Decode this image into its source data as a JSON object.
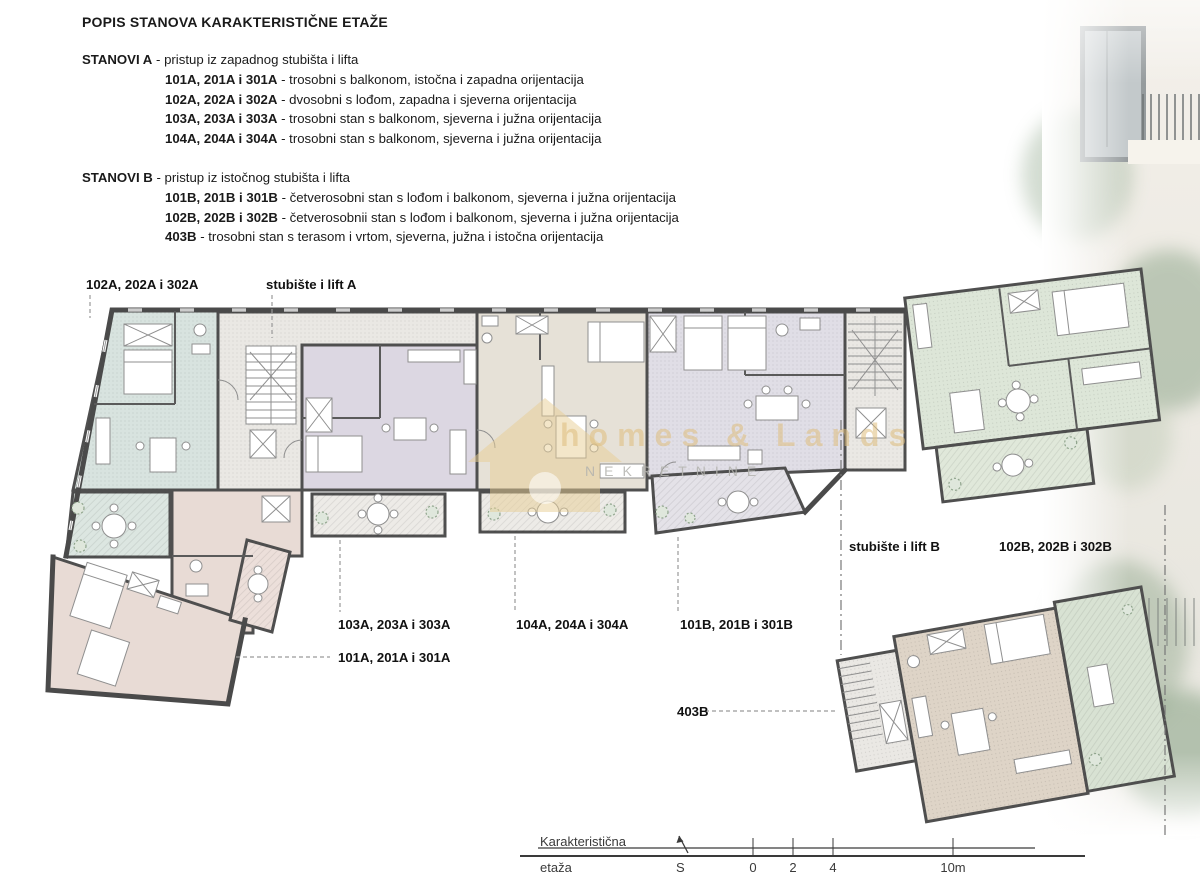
{
  "header": {
    "title": "POPIS STANOVA KARAKTERISTIČNE ETAŽE"
  },
  "sections": [
    {
      "name": "STANOVI A",
      "subtitle": "- pristup iz zapadnog stubišta i lifta",
      "units": [
        {
          "id": "101A, 201A i 301A",
          "desc": "- trosobni s balkonom, istočna i zapadna orijentacija"
        },
        {
          "id": "102A, 202A i 302A",
          "desc": "- dvosobni s lođom, zapadna i sjeverna orijentacija"
        },
        {
          "id": "103A, 203A i 303A",
          "desc": "- trosobni stan s balkonom, sjeverna i južna orijentacija"
        },
        {
          "id": "104A, 204A i 304A",
          "desc": "- trosobni stan s balkonom, sjeverna i južna orijentacija"
        }
      ]
    },
    {
      "name": "STANOVI B",
      "subtitle": "- pristup iz istočnog stubišta i lifta",
      "units": [
        {
          "id": "101B, 201B i 301B",
          "desc": "- četverosobni stan s lođom i balkonom, sjeverna i južna orijentacija"
        },
        {
          "id": "102B, 202B i 302B",
          "desc": "- četverosobnii stan s lođom i balkonom, sjeverna i južna orijentacija"
        },
        {
          "id": "403B",
          "desc": "- trosobni stan s terasom i vrtom, sjeverna, južna i istočna orijentacija"
        }
      ]
    }
  ],
  "plan": {
    "labels": {
      "unit_102a": "102A, 202A i 302A",
      "stairs_a": "stubište i lift A",
      "unit_103a": "103A, 203A i 303A",
      "unit_104a": "104A, 204A i 304A",
      "unit_101b": "101B, 201B i 301B",
      "unit_101a": "101A, 201A i 301A",
      "unit_403b": "403B",
      "stairs_b": "stubište i lift B",
      "unit_102b": "102B, 202B i 302B"
    }
  },
  "watermark": {
    "brand": "homes & Lands",
    "tagline": "NEKRETNINE"
  },
  "scale_bar": {
    "caption_line1": "Karakteristična",
    "caption_line2": "etaža",
    "north_label": "S",
    "ticks": [
      "0",
      "2",
      "4",
      "10m"
    ]
  },
  "colors": {
    "hall": "#eae8e4",
    "unit_102a": "#d8e3df",
    "terrace_102a": "#dce6e1",
    "unit_101a": "#e8dbd5",
    "balcony_101a": "#ecdfda",
    "unit_103a": "#dcd7e2",
    "unit_104a": "#e6e1d7",
    "unit_101b": "#e0dee6",
    "loggia_101b": "#e4e2e8",
    "unit_102b": "#dde6d8",
    "terrace_102b": "#e0e8da",
    "unit_403b": "#ded4c7",
    "terrace_403b": "#d8e2d3",
    "balcony": "#edebe7",
    "walls": "#4f4f4f",
    "watermark_gold": "#dfbe7e"
  }
}
